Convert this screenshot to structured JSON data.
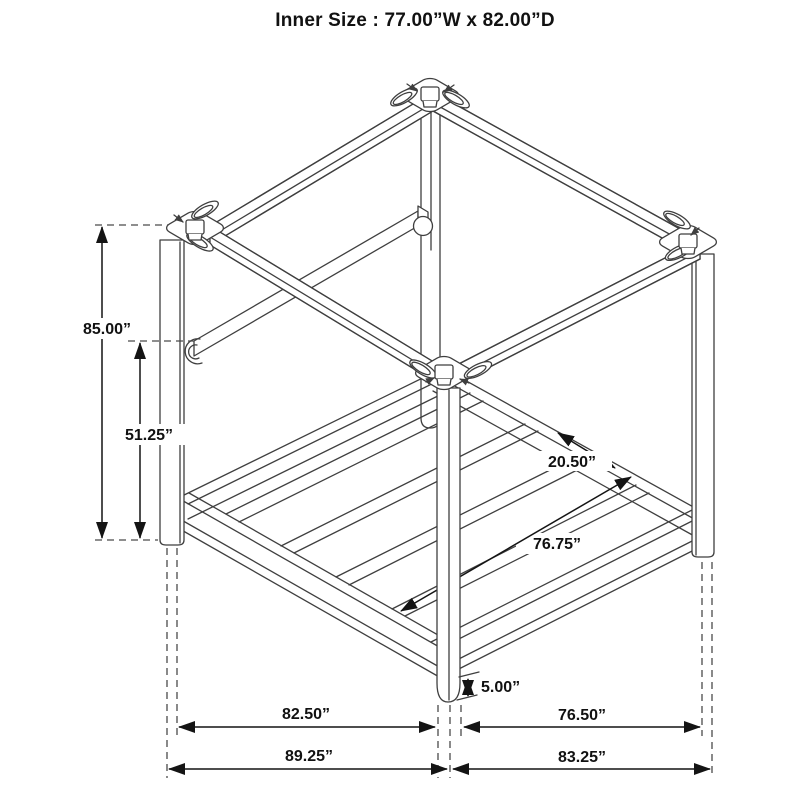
{
  "title": "Inner Size : 77.00”W x 82.00”D",
  "diagram": {
    "subject": "canopy-bed-frame-isometric-dimension-drawing",
    "colors": {
      "line": "#3f3f3f",
      "dimension": "#141414",
      "text": "#111111",
      "background": "#ffffff"
    }
  },
  "dimensions": {
    "overall_height": "85.00”",
    "rail_height": "51.25”",
    "slat_spacing": "20.50”",
    "platform_inner_depth": "76.75”",
    "ground_clearance": "5.00”",
    "width_inner": "82.50”",
    "depth_inner": "76.50”",
    "width_overall": "89.25”",
    "depth_overall": "83.25”"
  }
}
